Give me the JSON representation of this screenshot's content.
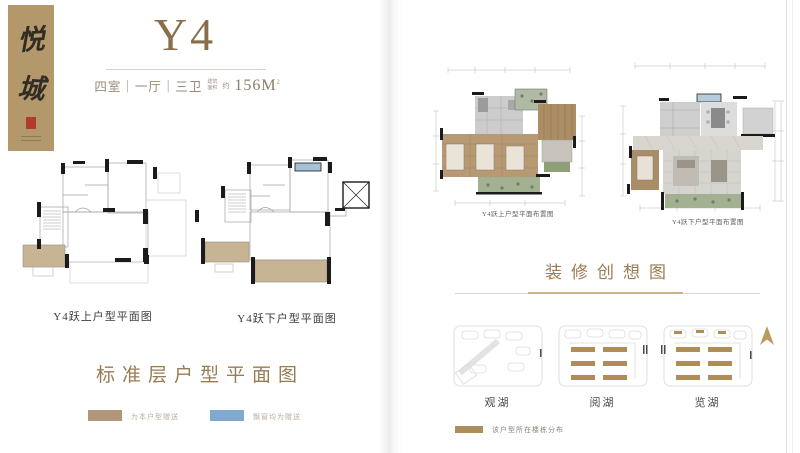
{
  "brand": {
    "vertical_title_char1": "悦",
    "vertical_title_char2": "城"
  },
  "unit": {
    "title": "Y4",
    "spec": "四室｜一厅｜三卫",
    "area_label_line1": "建筑",
    "area_label_line2": "面积",
    "area_approx": "约",
    "area_value": "156M",
    "area_sup": "2"
  },
  "left_page": {
    "plan_upper_caption": "Y4跃上户型平面图",
    "plan_lower_caption": "Y4跃下户型平面图",
    "section_title": "标准层户型平面图",
    "legend": [
      {
        "color": "#b0977a",
        "label": "为本户型赠送"
      },
      {
        "color": "#80a9d0",
        "label": "飘窗均为赠送"
      }
    ]
  },
  "right_page": {
    "plan_upper_caption": "Y4跃上户型平面布置图",
    "plan_lower_caption": "Y4跃下户型平面布置图",
    "section_title": "装修创想图",
    "maps": [
      {
        "label": "观湖"
      },
      {
        "label": "阅湖"
      },
      {
        "label": "览湖"
      }
    ],
    "legend_label": "该户型所在楼栋分布",
    "north_arrow": "north-arrow"
  },
  "colors": {
    "banner_tan": "#b2986b",
    "title_brown": "#8a6e4b",
    "heading_brown": "#9b7b52",
    "gift_area_tan": "#c7b493",
    "bay_window_blue": "#a5c2d8",
    "building_tan": "#b08d55",
    "seal_red": "#b23a2c",
    "wall_black": "#1b1b1b"
  }
}
